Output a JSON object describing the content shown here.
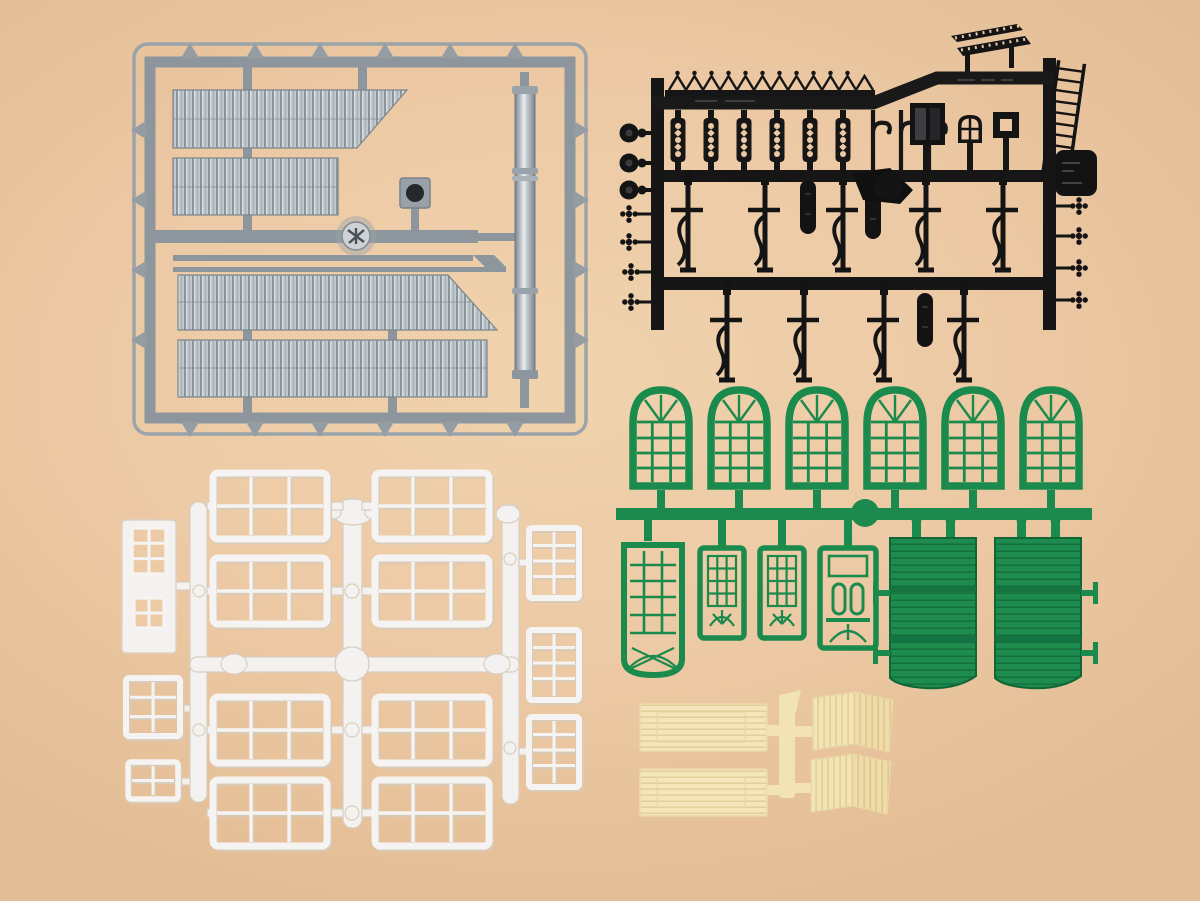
{
  "image": {
    "type": "product-photograph",
    "subject": "Plastic model-railway building accessory sprues laid on a plain surface",
    "background_color": "#ecc9a4",
    "visible_text": "none (only illegible embossed mould markings on the black sprue plates)"
  },
  "palette": {
    "background": "#ecc9a4",
    "gray_sprue": "#8d969d",
    "gray_metal_light": "#c6ccd1",
    "black_sprue": "#161616",
    "green_sprue": "#1b8a4d",
    "green_dark": "#136a3a",
    "white_sprue": "#f3f2f0",
    "white_shadow": "#d8cbba",
    "cream_sprue": "#f5e5b6",
    "cream_stripe": "#e4d09c"
  },
  "sprues": [
    {
      "id": "gray-sprue",
      "label": "Gray sprue: corrugated roof sheets, chimney pipe, vent wheel and flange in rectangular runner frame",
      "color": "#8d969d",
      "parts": [
        "corrugated panel with angled end",
        "corrugated panel small",
        "corrugated panel wide angled",
        "corrugated panel long",
        "chimney pipe",
        "square flange with hole",
        "round vent wheel",
        "runner frame with tabs"
      ]
    },
    {
      "id": "black-sprue",
      "label": "Black sprue: platform canopy details - roof crest, bench, ladder, filigree posts, lamp hooks, scroll wall brackets, windows, signal discs and rosettes",
      "color": "#161616",
      "parts": [
        "roof crest fence",
        "slatted bench",
        "ladder",
        "6 filigree posts",
        "3 lamp hooks",
        "dark window frame",
        "arched window",
        "square frame",
        "5 scroll brackets middle row",
        "4 scroll brackets bottom row",
        "3 oval sign paddles",
        "3 signal discs",
        "8 rosettes",
        "marking plate"
      ]
    },
    {
      "id": "green-sprue",
      "label": "Green sprue: six arched multi-pane windows, glazed doors and two planked gate doors",
      "color": "#1b8a4d",
      "parts": [
        "6 arched multi-pane windows",
        "wide glazed door with fan",
        "2 narrow glazed doors",
        "door with twin lights",
        "2 planked gate doors with hinge pins"
      ]
    },
    {
      "id": "white-sprue",
      "label": "White sprue: eight large six-pane windows, three small eight-pane windows, door with window panels, medium and small windows",
      "color": "#f3f2f0",
      "parts": [
        "8 large 6-pane windows",
        "3 small 8-pane windows",
        "door with upper and lower window",
        "medium 6-pane window",
        "small 4-pane window",
        "runner cross with knobs"
      ]
    },
    {
      "id": "cream-sprue",
      "label": "Cream sprue: two planked wall panels and two folded plank sections",
      "color": "#f5e5b6",
      "parts": [
        "2 horizontal planked panels",
        "2 folded vertical-plank sections",
        "central runner"
      ]
    }
  ]
}
